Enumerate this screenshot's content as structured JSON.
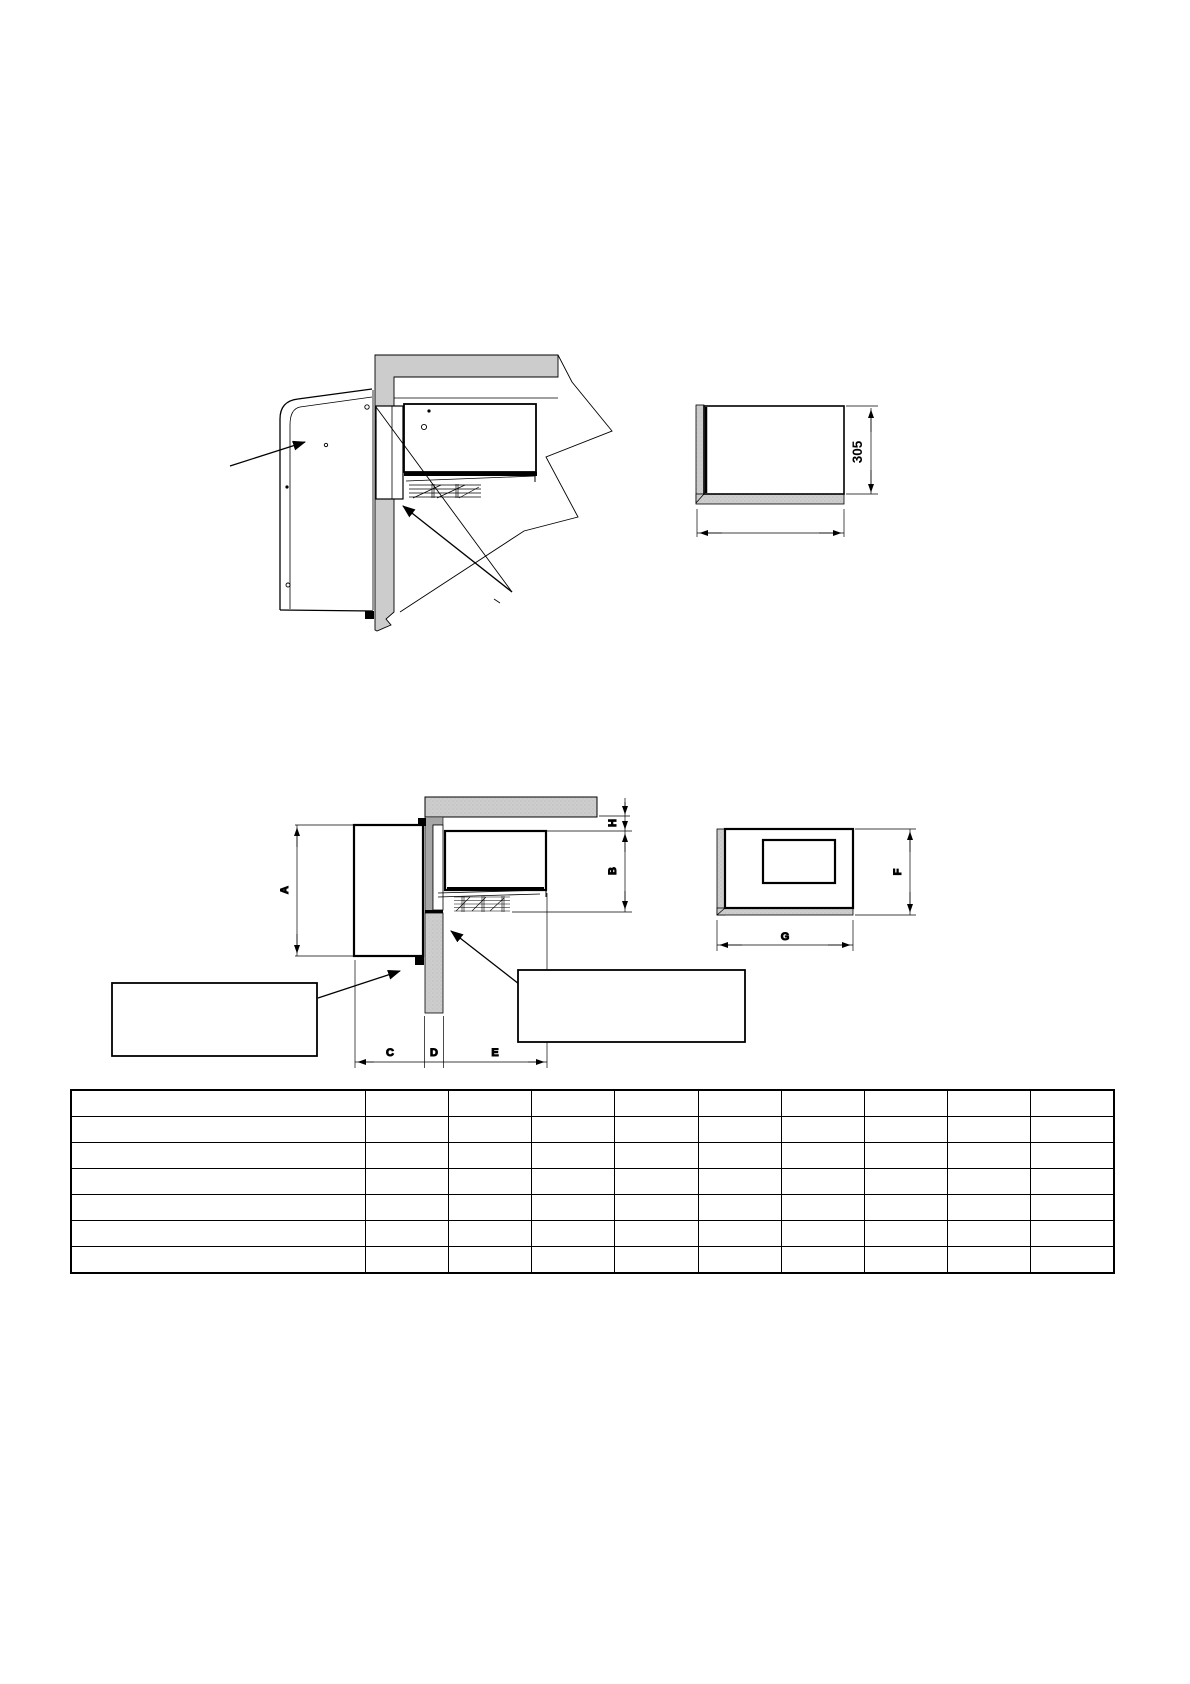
{
  "page": {
    "kind": "technical-drawing-manual-page"
  },
  "colors": {
    "line": "#000000",
    "paper": "#ffffff",
    "wall_light_gray": "#cccccc",
    "wall_dark_gray": "#a6a6a6"
  },
  "side_view": {
    "description": "side section of through-wall unit with cover, wall and evaporator"
  },
  "rear_view": {
    "depth_dim": "305"
  },
  "dimension_view": {
    "dims": {
      "a": "A",
      "b": "B",
      "c": "C",
      "d": "D",
      "e": "E",
      "h": "H"
    },
    "callout_left_text": "",
    "callout_right_text": ""
  },
  "front_view": {
    "dims": {
      "f": "F",
      "g": "G"
    }
  },
  "table": {
    "row_count": 7,
    "col_count": 10,
    "rows": [
      [
        "",
        "",
        "",
        "",
        "",
        "",
        "",
        "",
        "",
        ""
      ],
      [
        "",
        "",
        "",
        "",
        "",
        "",
        "",
        "",
        "",
        ""
      ],
      [
        "",
        "",
        "",
        "",
        "",
        "",
        "",
        "",
        "",
        ""
      ],
      [
        "",
        "",
        "",
        "",
        "",
        "",
        "",
        "",
        "",
        ""
      ],
      [
        "",
        "",
        "",
        "",
        "",
        "",
        "",
        "",
        "",
        ""
      ],
      [
        "",
        "",
        "",
        "",
        "",
        "",
        "",
        "",
        "",
        ""
      ],
      [
        "",
        "",
        "",
        "",
        "",
        "",
        "",
        "",
        "",
        ""
      ]
    ]
  }
}
